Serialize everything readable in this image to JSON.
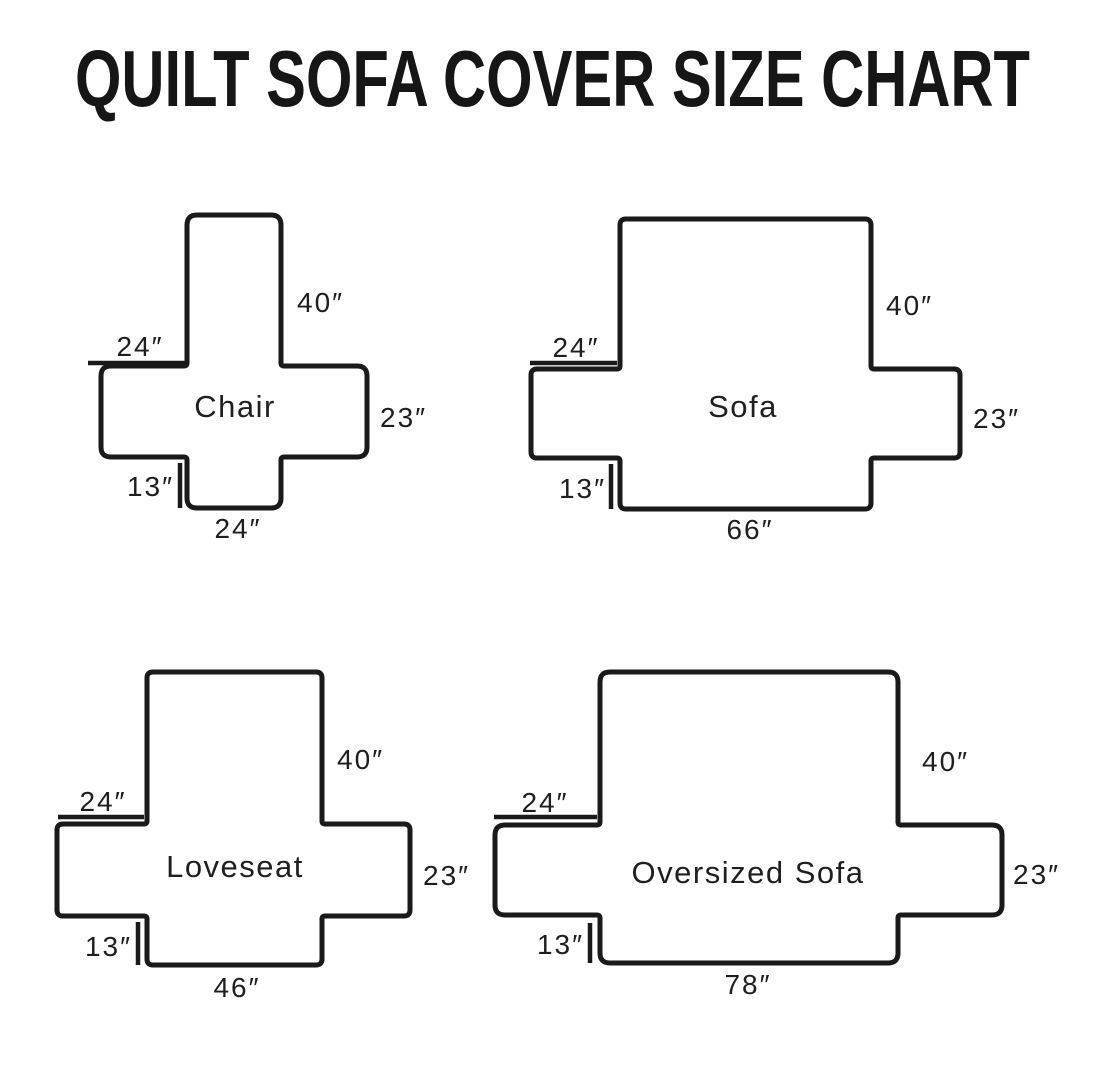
{
  "header": {
    "title": "QUILT SOFA COVER SIZE CHART"
  },
  "colors": {
    "ink": "#1a1a1a",
    "background": "#ffffff"
  },
  "diagrams": [
    {
      "name": "Chair",
      "back_height": "40″",
      "arm_width": "24″",
      "skirt_drop": "13″",
      "seat_depth": "23″",
      "base_width": "24″"
    },
    {
      "name": "Sofa",
      "back_height": "40″",
      "arm_width": "24″",
      "skirt_drop": "13″",
      "seat_depth": "23″",
      "base_width": "66″"
    },
    {
      "name": "Loveseat",
      "back_height": "40″",
      "arm_width": "24″",
      "skirt_drop": "13″",
      "seat_depth": "23″",
      "base_width": "46″"
    },
    {
      "name": "Oversized Sofa",
      "back_height": "40″",
      "arm_width": "24″",
      "skirt_drop": "13″",
      "seat_depth": "23″",
      "base_width": "78″"
    }
  ]
}
